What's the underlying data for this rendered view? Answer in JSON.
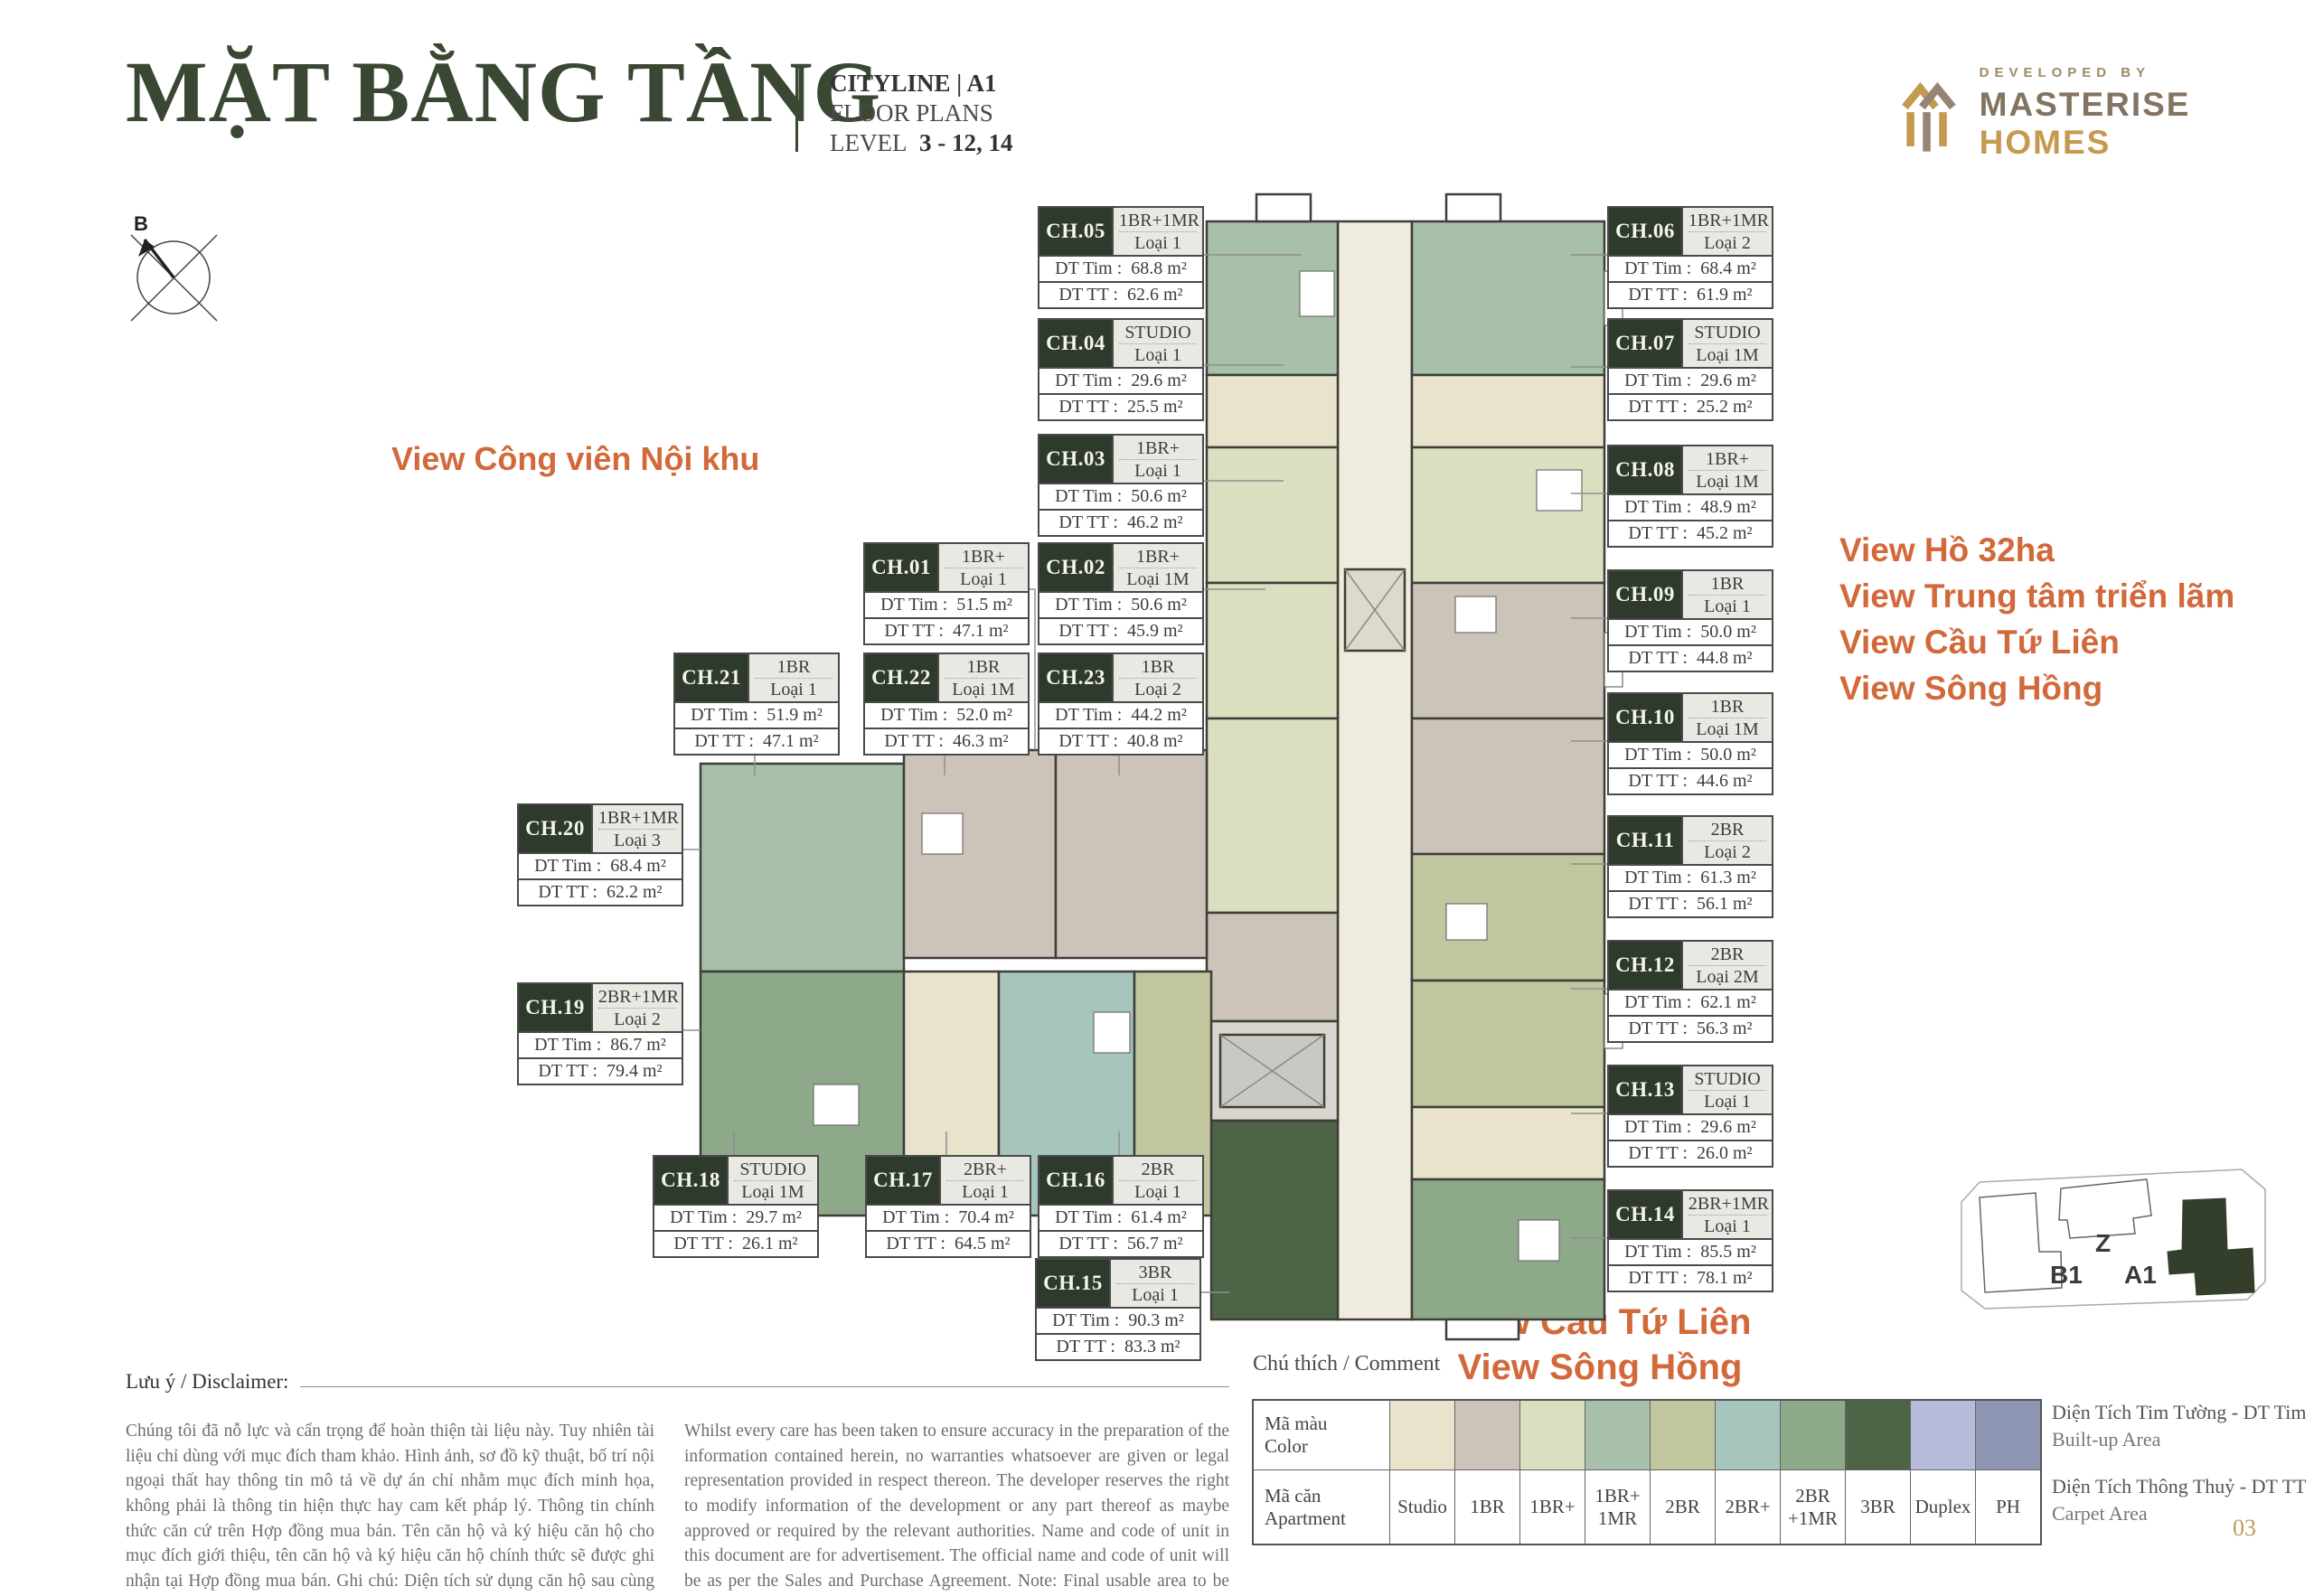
{
  "header": {
    "title": "MẶT BẰNG TẦNG",
    "project": "CITYLINE | A1",
    "subtitle": "FLOOR PLANS",
    "level_label": "LEVEL",
    "level_value": "3 - 12, 14",
    "developed_by": "DEVELOPED BY",
    "brand_primary": "MASTERISE",
    "brand_secondary": "HOMES"
  },
  "compass": {
    "label": "B"
  },
  "annotations": {
    "accent_color": "#d2693b",
    "view_left": "View Công viên Nội khu",
    "views_right": [
      "View Hồ 32ha",
      "View Trung tâm triển lãm",
      "View Cầu Tứ Liên",
      "View Sông Hồng"
    ],
    "views_bottom": [
      "View Cầu Tứ Liên",
      "View Sông Hồng"
    ]
  },
  "unit_fields": {
    "tim_label": "DT Tim",
    "tt_label": "DT TT"
  },
  "units": [
    {
      "code": "CH.01",
      "type": "1BR+",
      "variant": "Loại 1",
      "dt_tim": "51.5 m²",
      "dt_tt": "47.1 m²"
    },
    {
      "code": "CH.02",
      "type": "1BR+",
      "variant": "Loại 1M",
      "dt_tim": "50.6 m²",
      "dt_tt": "45.9 m²"
    },
    {
      "code": "CH.03",
      "type": "1BR+",
      "variant": "Loại 1",
      "dt_tim": "50.6 m²",
      "dt_tt": "46.2 m²"
    },
    {
      "code": "CH.04",
      "type": "STUDIO",
      "variant": "Loại 1",
      "dt_tim": "29.6 m²",
      "dt_tt": "25.5 m²"
    },
    {
      "code": "CH.05",
      "type": "1BR+1MR",
      "variant": "Loại 1",
      "dt_tim": "68.8 m²",
      "dt_tt": "62.6 m²"
    },
    {
      "code": "CH.06",
      "type": "1BR+1MR",
      "variant": "Loại 2",
      "dt_tim": "68.4 m²",
      "dt_tt": "61.9 m²"
    },
    {
      "code": "CH.07",
      "type": "STUDIO",
      "variant": "Loại 1M",
      "dt_tim": "29.6 m²",
      "dt_tt": "25.2 m²"
    },
    {
      "code": "CH.08",
      "type": "1BR+",
      "variant": "Loại 1M",
      "dt_tim": "48.9 m²",
      "dt_tt": "45.2 m²"
    },
    {
      "code": "CH.09",
      "type": "1BR",
      "variant": "Loại 1",
      "dt_tim": "50.0 m²",
      "dt_tt": "44.8 m²"
    },
    {
      "code": "CH.10",
      "type": "1BR",
      "variant": "Loại 1M",
      "dt_tim": "50.0 m²",
      "dt_tt": "44.6 m²"
    },
    {
      "code": "CH.11",
      "type": "2BR",
      "variant": "Loại 2",
      "dt_tim": "61.3 m²",
      "dt_tt": "56.1 m²"
    },
    {
      "code": "CH.12",
      "type": "2BR",
      "variant": "Loại 2M",
      "dt_tim": "62.1 m²",
      "dt_tt": "56.3 m²"
    },
    {
      "code": "CH.13",
      "type": "STUDIO",
      "variant": "Loại 1",
      "dt_tim": "29.6 m²",
      "dt_tt": "26.0 m²"
    },
    {
      "code": "CH.14",
      "type": "2BR+1MR",
      "variant": "Loại 1",
      "dt_tim": "85.5 m²",
      "dt_tt": "78.1 m²"
    },
    {
      "code": "CH.15",
      "type": "3BR",
      "variant": "Loại 1",
      "dt_tim": "90.3 m²",
      "dt_tt": "83.3 m²"
    },
    {
      "code": "CH.16",
      "type": "2BR",
      "variant": "Loại 1",
      "dt_tim": "61.4 m²",
      "dt_tt": "56.7 m²"
    },
    {
      "code": "CH.17",
      "type": "2BR+",
      "variant": "Loại 1",
      "dt_tim": "70.4 m²",
      "dt_tt": "64.5 m²"
    },
    {
      "code": "CH.18",
      "type": "STUDIO",
      "variant": "Loại 1M",
      "dt_tim": "29.7 m²",
      "dt_tt": "26.1 m²"
    },
    {
      "code": "CH.19",
      "type": "2BR+1MR",
      "variant": "Loại 2",
      "dt_tim": "86.7 m²",
      "dt_tt": "79.4 m²"
    },
    {
      "code": "CH.20",
      "type": "1BR+1MR",
      "variant": "Loại 3",
      "dt_tim": "68.4 m²",
      "dt_tt": "62.2 m²"
    },
    {
      "code": "CH.21",
      "type": "1BR",
      "variant": "Loại 1",
      "dt_tim": "51.9 m²",
      "dt_tt": "47.1 m²"
    },
    {
      "code": "CH.22",
      "type": "1BR",
      "variant": "Loại 1M",
      "dt_tim": "52.0 m²",
      "dt_tt": "46.3 m²"
    },
    {
      "code": "CH.23",
      "type": "1BR",
      "variant": "Loại 2",
      "dt_tim": "44.2 m²",
      "dt_tt": "40.8 m²"
    }
  ],
  "legend": {
    "title": "Chú thích / Comment",
    "color_label_vi": "Mã màu",
    "color_label_en": "Color",
    "apt_label_vi": "Mã căn",
    "apt_label_en": "Apartment",
    "items": [
      {
        "label": "Studio",
        "color": "#e9e3cb"
      },
      {
        "label": "1BR",
        "color": "#cdc4b9"
      },
      {
        "label": "1BR+",
        "color": "#dcdec0"
      },
      {
        "label": "1BR+ 1MR",
        "color": "#a8bfaa"
      },
      {
        "label": "2BR",
        "color": "#c2c69e"
      },
      {
        "label": "2BR+",
        "color": "#a6c5bc"
      },
      {
        "label": "2BR +1MR",
        "color": "#8ea88a"
      },
      {
        "label": "3BR",
        "color": "#4d6446"
      },
      {
        "label": "Duplex",
        "color": "#b5bbd8"
      },
      {
        "label": "PH",
        "color": "#8e96b4"
      }
    ],
    "notes": [
      {
        "vi": "Diện Tích Tim Tường - DT Tim",
        "en": "Built-up Area"
      },
      {
        "vi": "Diện Tích Thông Thuỷ - DT TT",
        "en": "Carpet Area"
      }
    ]
  },
  "disclaimer": {
    "label": "Lưu ý / Disclaimer:",
    "vi": "Chúng tôi đã nỗ lực và cẩn trọng để hoàn thiện tài liệu này. Tuy nhiên tài liệu chỉ dùng với mục đích tham khảo. Hình ảnh, sơ đồ kỹ thuật, bố trí nội ngoại thất hay thông tin mô tả về dự án chỉ nhằm mục đích minh họa, không phải là thông tin hiện thực hay cam kết pháp lý. Thông tin chính thức căn cứ trên Hợp đồng mua bán. Tên căn hộ và ký hiệu căn hộ cho mục đích giới thiệu, tên căn hộ và ký hiệu căn hộ chính thức sẽ được ghi nhận tại Hợp đồng mua bán. Ghi chú: Diện tích sử dụng căn hộ sau cùng sẽ được xác minh bởi đơn vị đo đạc.",
    "en": "Whilst every care has been taken to ensure accuracy in the preparation of the information contained herein, no warranties whatsoever are given or legal representation provided in respect thereon. The developer reserves the right to modify information of the development or any part thereof as maybe approved or required by the relevant authorities. Name and code of unit in this document are for advertisement. The official name and code of unit will be as per the Sales and Purchase Agreement. Note: Final usable area to be verified by surveyor."
  },
  "minimap": {
    "z": "Z",
    "b1": "B1",
    "a1": "A1"
  },
  "page_number": "03"
}
